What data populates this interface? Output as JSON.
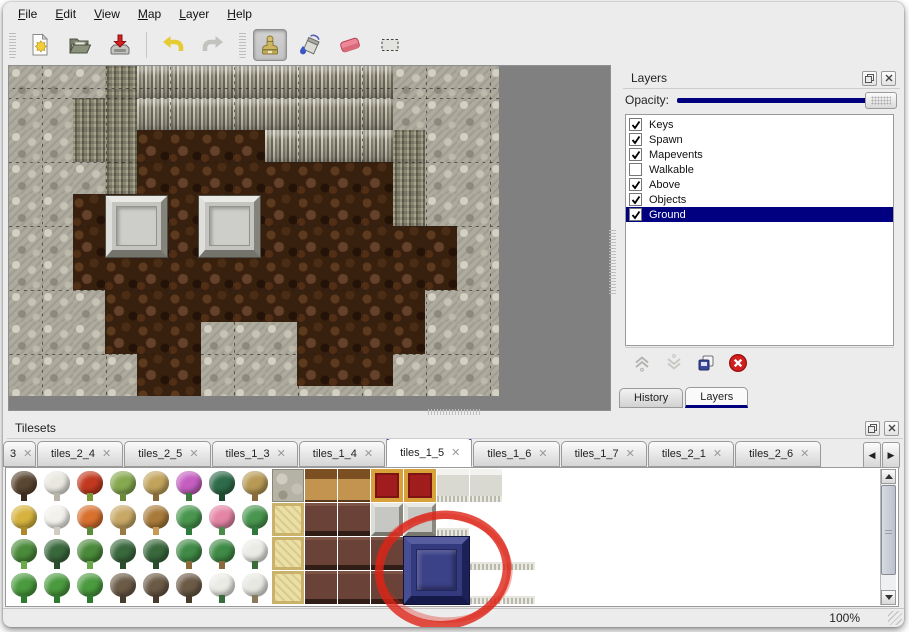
{
  "menu": {
    "items": [
      "File",
      "Edit",
      "View",
      "Map",
      "Layer",
      "Help"
    ]
  },
  "toolbar": {
    "icons": [
      "new-file",
      "open-file",
      "save-file",
      "undo",
      "redo",
      "stamp-tool",
      "fill-tool",
      "eraser-tool",
      "select-tool"
    ],
    "active_tool": "stamp-tool"
  },
  "map": {
    "tile_size": 32,
    "rows": [
      "RRRMCCCCCCCCRRRR",
      "RRMMCCCCCCCCRRRR",
      "RRMMBBBBCCCCMRRR",
      "RRRMBBBBBBBBMRRR",
      "RRBBBBBBBBBBMRRR",
      "RRBBBBBBBBBBBBRR",
      "RRBBBBBBBBBBBBRR",
      "RRRBBBBBBBBBBRRR",
      "RRRBBBRRRBBBBRRR",
      "RRRRBBRRRBBBRRRR",
      "RRRRBBRRRRRRRRRR"
    ],
    "platforms": [
      {
        "x": 97,
        "y": 130
      },
      {
        "x": 190,
        "y": 130
      }
    ]
  },
  "layers_panel": {
    "title": "Layers",
    "opacity_label": "Opacity:",
    "opacity_value": 100,
    "layers": [
      {
        "name": "Keys",
        "checked": true,
        "selected": false
      },
      {
        "name": "Spawn",
        "checked": true,
        "selected": false
      },
      {
        "name": "Mapevents",
        "checked": true,
        "selected": false
      },
      {
        "name": "Walkable",
        "checked": false,
        "selected": false
      },
      {
        "name": "Above",
        "checked": true,
        "selected": false
      },
      {
        "name": "Objects",
        "checked": true,
        "selected": false
      },
      {
        "name": "Ground",
        "checked": true,
        "selected": true
      }
    ],
    "buttons": [
      "raise-layer",
      "lower-layer",
      "duplicate-layer",
      "delete-layer"
    ],
    "tabs": [
      {
        "label": "History",
        "active": false
      },
      {
        "label": "Layers",
        "active": true
      }
    ]
  },
  "tilesets_panel": {
    "title": "Tilesets",
    "tabs": [
      {
        "label": "3",
        "active": false,
        "clipped": true
      },
      {
        "label": "tiles_2_4",
        "active": false
      },
      {
        "label": "tiles_2_5",
        "active": false
      },
      {
        "label": "tiles_1_3",
        "active": false
      },
      {
        "label": "tiles_1_4",
        "active": false
      },
      {
        "label": "tiles_1_5",
        "active": true
      },
      {
        "label": "tiles_1_6",
        "active": false
      },
      {
        "label": "tiles_1_7",
        "active": false
      },
      {
        "label": "tiles_2_1",
        "active": false
      },
      {
        "label": "tiles_2_6",
        "active": false
      }
    ],
    "tile_types": {
      "tree-dead": {
        "c1": "#5a4632",
        "c2": "#3a2c1e"
      },
      "tree-snow": {
        "c1": "#e9e7df",
        "c2": "#b8b5a8"
      },
      "flower-red": {
        "c1": "#c2391f",
        "c2": "#7a9a3a"
      },
      "stump": {
        "c1": "#86a84e",
        "c2": "#6a8a3a"
      },
      "trunk": {
        "c1": "#c2a35c",
        "c2": "#8a6a3a"
      },
      "bush-pink": {
        "c1": "#c55ec0",
        "c2": "#3a7a3a"
      },
      "plant-dark": {
        "c1": "#2e6b4a",
        "c2": "#1e4a32"
      },
      "plant-tan": {
        "c1": "#b89a55",
        "c2": "#8a6a3a"
      },
      "hay": {
        "c1": "#d6b33e",
        "c2": "#b08a2a"
      },
      "mound-snow": {
        "c1": "#f2f1ec",
        "c2": "#cfccc2"
      },
      "flower-orange": {
        "c1": "#d8702e",
        "c2": "#5a8a3a"
      },
      "grass-dry": {
        "c1": "#c8a866",
        "c2": "#9a7a42"
      },
      "leaves": {
        "c1": "#a87a3a",
        "c2": "#c89a55"
      },
      "lily": {
        "c1": "#49964f",
        "c2": "#2e7a3a"
      },
      "roses": {
        "c1": "#e585a5",
        "c2": "#4a8a4a"
      },
      "sprouts": {
        "c1": "#4a8a3a",
        "c2": "#6aa84a"
      },
      "bush": {
        "c1": "#39683c",
        "c2": "#2a4e2c"
      },
      "palm": {
        "c1": "#3f8a46",
        "c2": "#8a6a3a"
      },
      "pine-snow": {
        "c1": "#ebebe6",
        "c2": "#3a6b3a"
      },
      "cone": {
        "c1": "#4a9a3e",
        "c2": "#2e7a30"
      },
      "tree-twist": {
        "c1": "#6b5a46",
        "c2": "#4a3a2c"
      },
      "stump-snow": {
        "c1": "#e8e8e2",
        "c2": "#8a7a5a"
      }
    },
    "grid": [
      [
        "tree-dead",
        "tree-snow",
        "flower-red",
        "stump",
        "trunk",
        "bush-pink",
        "plant-dark",
        "plant-tan",
        "stone",
        "tanfloor",
        "tanfloor",
        "carpet",
        "carpet",
        "cloth",
        "cloth",
        "blank"
      ],
      [
        "hay",
        "mound-snow",
        "flower-orange",
        "grass-dry",
        "leaves",
        "lily",
        "roses",
        "lily",
        "yellowfloor",
        "maroon",
        "maroon",
        "grayblock",
        "grayblock",
        "whitetile",
        "blank",
        "blank"
      ],
      [
        "sprouts",
        "bush",
        "sprouts",
        "bush",
        "bush",
        "palm",
        "palm",
        "pine-snow",
        "yellowfloor",
        "maroon",
        "maroon",
        "maroon",
        "blank",
        "blank",
        "whitetile",
        "whitetile"
      ],
      [
        "cone",
        "cone",
        "cone",
        "tree-twist",
        "tree-twist",
        "tree-twist",
        "pine-snow",
        "stump-snow",
        "yellowfloor",
        "maroon",
        "maroon",
        "maroon",
        "blank",
        "blank",
        "whitetile",
        "whitetile"
      ]
    ],
    "selected_tile": {
      "col": 12,
      "row": 2,
      "w": 2,
      "h": 2,
      "color": "#343a7e"
    },
    "annotation": {
      "shape": "ellipse",
      "color": "#dd2418"
    }
  },
  "status_bar": {
    "zoom": "100%"
  }
}
